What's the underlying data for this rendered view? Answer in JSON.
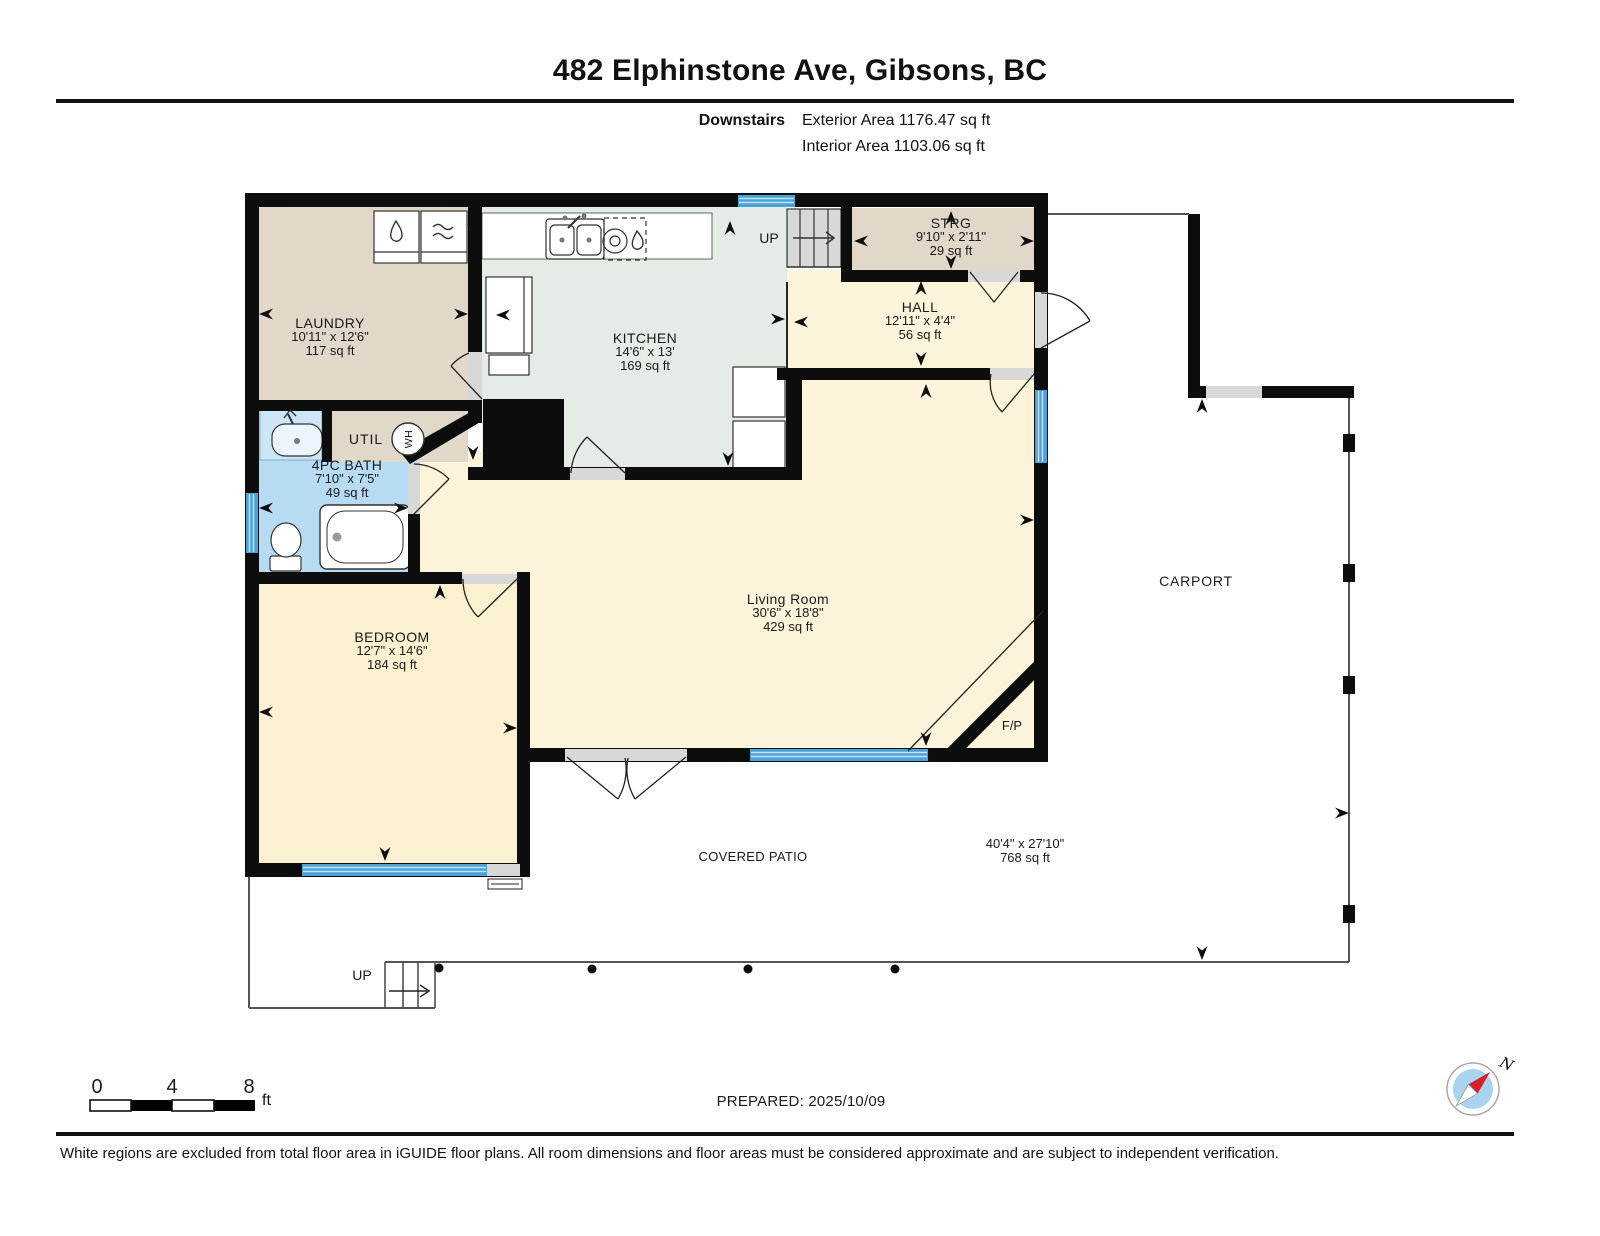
{
  "header": {
    "title": "482 Elphinstone Ave, Gibsons, BC",
    "floor_label": "Downstairs",
    "exterior_area": "Exterior Area 1176.47 sq ft",
    "interior_area": "Interior Area 1103.06 sq ft"
  },
  "rooms": [
    {
      "name": "LAUNDRY",
      "dims": "10'11\" x 12'6\"",
      "area": "117 sq ft"
    },
    {
      "name": "KITCHEN",
      "dims": "14'6\" x 13'",
      "area": "169 sq ft"
    },
    {
      "name": "STRG",
      "dims": "9'10\" x 2'11\"",
      "area": "29 sq ft"
    },
    {
      "name": "HALL",
      "dims": "12'11\" x 4'4\"",
      "area": "56 sq ft"
    },
    {
      "name": "Living Room",
      "dims": "30'6\" x 18'8\"",
      "area": "429 sq ft"
    },
    {
      "name": "4PC BATH",
      "dims": "7'10\" x 7'5\"",
      "area": "49 sq ft"
    },
    {
      "name": "BEDROOM",
      "dims": "12'7\" x 14'6\"",
      "area": "184 sq ft"
    }
  ],
  "labels": {
    "up_top": "UP",
    "up_bottom": "UP",
    "util": "UTIL",
    "wh": "WH",
    "fp": "F/P",
    "carport": "CARPORT",
    "covered_patio": "COVERED PATIO",
    "patio_dims": "40'4\" x 27'10\"",
    "patio_area": "768 sq ft"
  },
  "scalebar": {
    "t0": "0",
    "t4": "4",
    "t8": "8",
    "unit": "ft"
  },
  "footer": {
    "prepared": "PREPARED: 2025/10/09",
    "compass_n": "N",
    "disclaimer": "White regions are excluded from total floor area in iGUIDE floor plans. All room dimensions and floor areas must be considered approximate and are subject to independent verification."
  },
  "colors": {
    "wall": "#0d0d0d",
    "window_blue": "#4aa2d8",
    "bath_blue": "#b6dbf2",
    "kitchen_green": "#e4ece5",
    "beige": "#e2d8c9",
    "cream": "#fbf3da",
    "bedroom_cream": "#fbf1d1",
    "compass_red": "#d42127"
  }
}
